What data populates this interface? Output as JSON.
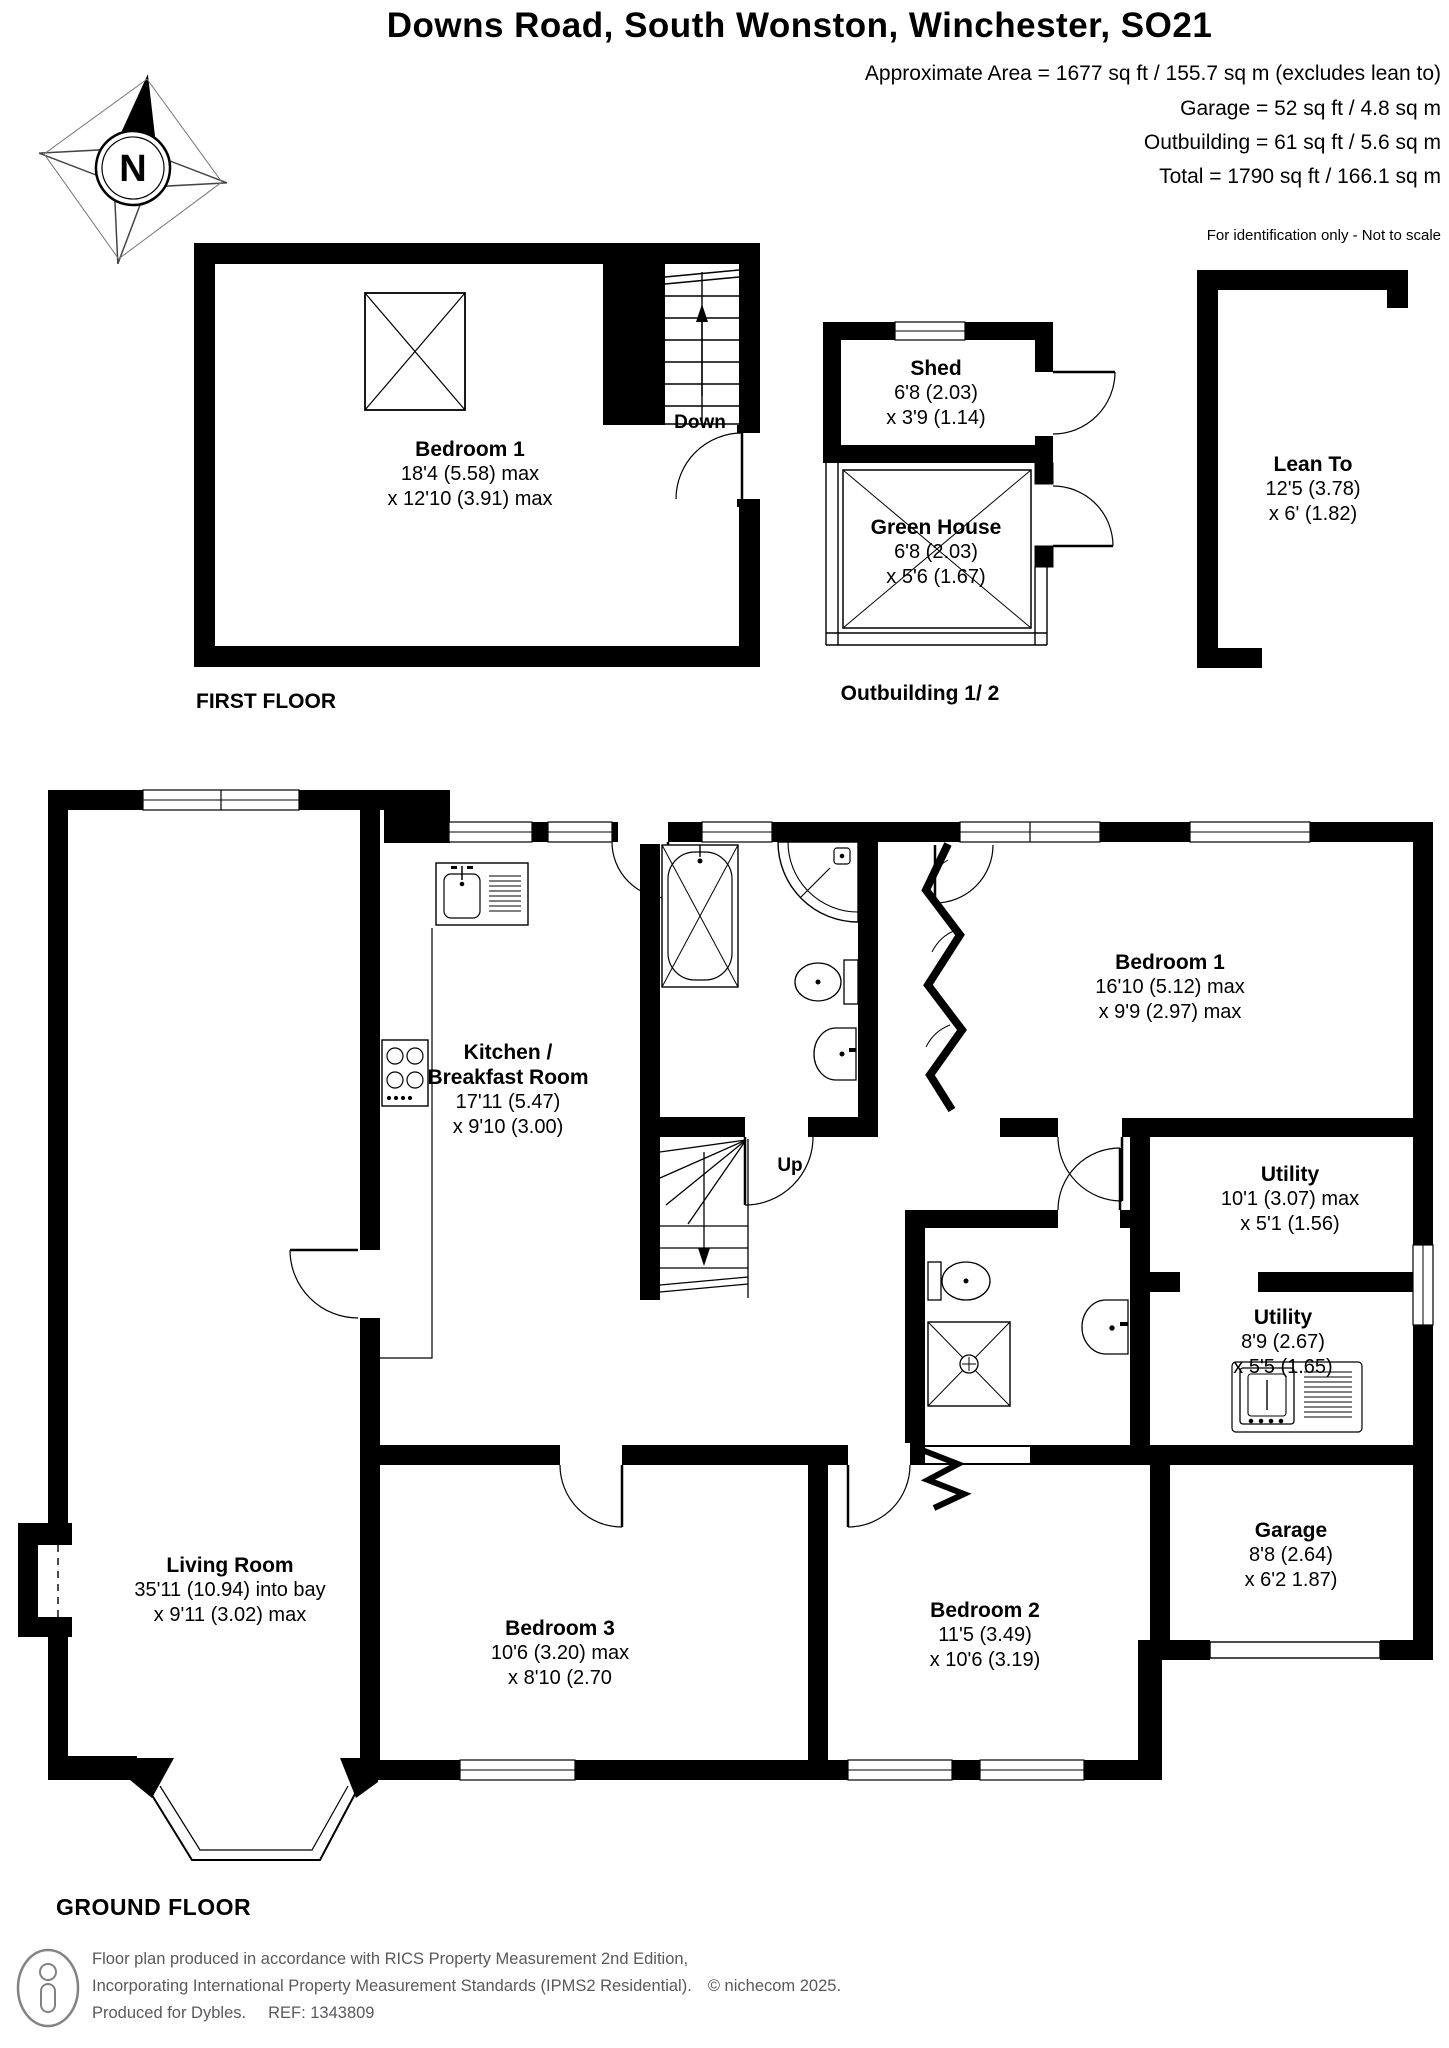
{
  "header": {
    "title": "Downs Road, South Wonston, Winchester, SO21",
    "area_lines": [
      "Approximate Area = 1677 sq ft / 155.7 sq m (excludes lean to)",
      "Garage = 52 sq ft / 4.8 sq m",
      "Outbuilding = 61 sq ft / 5.6 sq m",
      "Total = 1790 sq ft / 166.1 sq m"
    ],
    "disclaimer": "For identification only - Not to scale"
  },
  "compass": {
    "north_label": "N"
  },
  "floors": {
    "first": "FIRST FLOOR",
    "outbuilding": "Outbuilding 1/ 2",
    "ground": "GROUND FLOOR"
  },
  "stairs": {
    "down": "Down",
    "up": "Up"
  },
  "rooms": {
    "ff_bed1": {
      "name": "Bedroom 1",
      "dims": [
        "18'4 (5.58) max",
        "x 12'10 (3.91) max"
      ]
    },
    "shed": {
      "name": "Shed",
      "dims": [
        "6'8 (2.03)",
        "x 3'9 (1.14)"
      ]
    },
    "greenhouse": {
      "name": "Green House",
      "dims": [
        "6'8 (2.03)",
        "x 5'6 (1.67)"
      ]
    },
    "lean_to": {
      "name": "Lean To",
      "dims": [
        "12'5 (3.78)",
        "x 6' (1.82)"
      ]
    },
    "kitchen": {
      "name_lines": [
        "Kitchen /",
        "Breakfast Room"
      ],
      "dims": [
        "17'11 (5.47)",
        "x 9'10 (3.00)"
      ]
    },
    "gf_bed1": {
      "name": "Bedroom 1",
      "dims": [
        "16'10 (5.12) max",
        "x 9'9 (2.97) max"
      ]
    },
    "utility1": {
      "name": "Utility",
      "dims": [
        "10'1 (3.07) max",
        "x 5'1 (1.56)"
      ]
    },
    "utility2": {
      "name": "Utility",
      "dims": [
        "8'9 (2.67)",
        "x 5'5 (1.65)"
      ]
    },
    "garage": {
      "name": "Garage",
      "dims": [
        "8'8 (2.64)",
        "x 6'2 1.87)"
      ]
    },
    "living": {
      "name": "Living Room",
      "dims": [
        "35'11 (10.94) into bay",
        "x 9'11 (3.02) max"
      ]
    },
    "bed3": {
      "name": "Bedroom 3",
      "dims": [
        "10'6 (3.20) max",
        "x 8'10 (2.70"
      ]
    },
    "bed2": {
      "name": "Bedroom 2",
      "dims": [
        "11'5 (3.49)",
        "x 10'6 (3.19)"
      ]
    }
  },
  "footer": {
    "line1": "Floor plan produced in accordance with RICS Property Measurement 2nd Edition,",
    "line2": "Incorporating International Property Measurement Standards (IPMS2 Residential).",
    "copyright": "© nichecom 2025.",
    "produced": "Produced for Dybles.",
    "ref": "REF: 1343809"
  },
  "colors": {
    "wall": "#000000",
    "background": "#ffffff",
    "footer_text": "#58595b"
  }
}
